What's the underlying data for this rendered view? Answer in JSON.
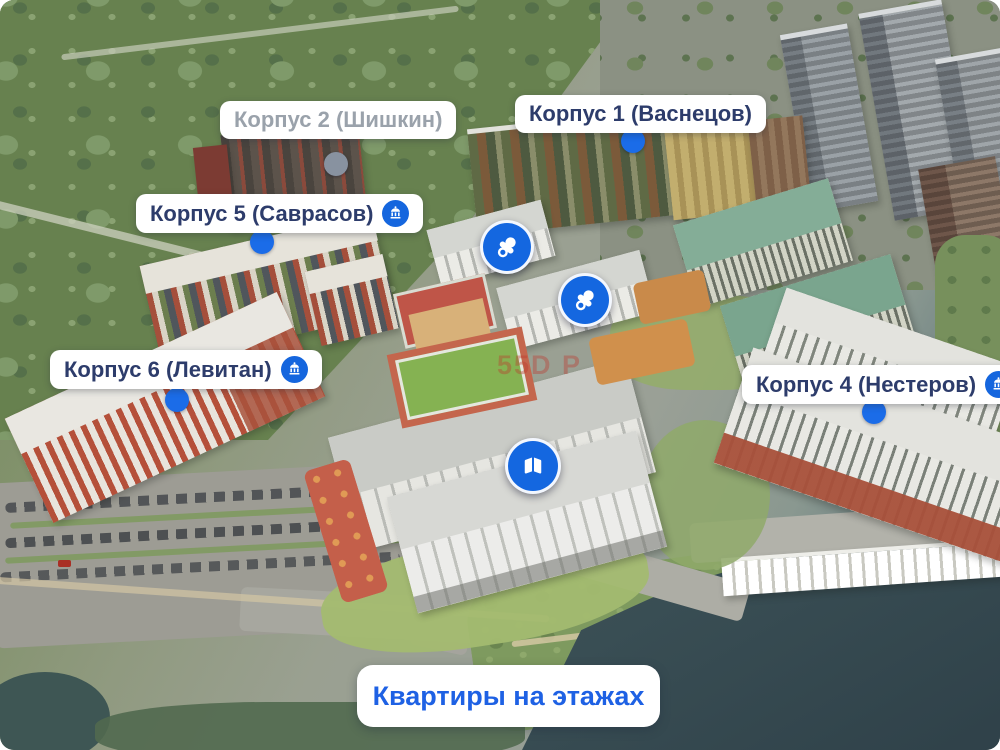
{
  "building_labels": [
    {
      "text": "Корпус 2 (Шишкин)",
      "state": "disabled",
      "has_info_icon": false
    },
    {
      "text": "Корпус 1 (Васнецов)",
      "state": "active",
      "has_info_icon": false
    },
    {
      "text": "Корпус 5 (Саврасов)",
      "state": "active",
      "has_info_icon": true
    },
    {
      "text": "Корпус 6 (Левитан)",
      "state": "active",
      "has_info_icon": true
    },
    {
      "text": "Корпус 4 (Нестеров)",
      "state": "active",
      "has_info_icon": true
    }
  ],
  "poi_markers": [
    {
      "name": "kindergarten-marker-1",
      "icon": "pacifier-icon"
    },
    {
      "name": "kindergarten-marker-2",
      "icon": "pacifier-icon"
    },
    {
      "name": "school-marker",
      "icon": "open-book-icon"
    }
  ],
  "footer": {
    "button_label": "Квартиры на этажах"
  },
  "watermark": {
    "text": "55D Р"
  },
  "colors": {
    "accent_blue": "#1b6ce8",
    "marker_blue": "#1467e0",
    "label_text": "#2d3c6b",
    "label_disabled_text": "#9aa2ab",
    "button_text": "#1e61e4",
    "disabled_dot": "#8892a0",
    "water": "#3a4f55",
    "forest": "#6d8757"
  }
}
